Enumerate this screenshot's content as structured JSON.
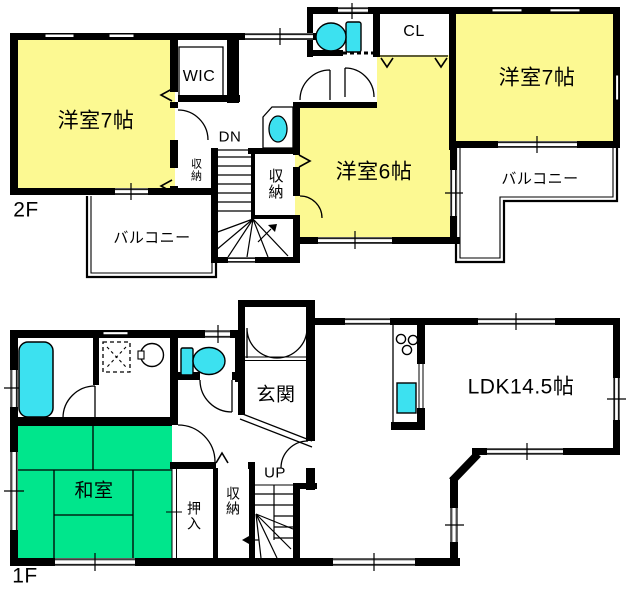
{
  "type": "floor_plan",
  "floors": [
    {
      "id": "2F",
      "tag": "2F",
      "rooms": {
        "bedroom_west": "洋室7帖",
        "bedroom_east": "洋室7帖",
        "bedroom_middle": "洋室6帖",
        "walk_in_closet": "WIC",
        "closet": "CL",
        "storage_small": "収納",
        "storage_east": "収納",
        "balcony_west": "バルコニー",
        "balcony_east": "バルコニー"
      },
      "stairs": "DN"
    },
    {
      "id": "1F",
      "tag": "1F",
      "rooms": {
        "entrance": "玄関",
        "ldk": "LDK14.5帖",
        "tatami_room": "和室",
        "futon_closet": "押入",
        "storage": "収納"
      },
      "stairs": "UP"
    }
  ],
  "colors": {
    "wall": "#000000",
    "room_yellow": "#FCF992",
    "tatami_green": "#00E68C",
    "water_cyan": "#3CE1F0",
    "background": "#FFFFFF"
  },
  "icons": [
    "toilet-icon",
    "bathtub-icon",
    "washbasin-icon",
    "washing-machine-icon",
    "stove-icon",
    "kitchen-sink-icon",
    "stairs-icon",
    "door-swing-icon",
    "window-icon",
    "chevron-opening-icon"
  ]
}
